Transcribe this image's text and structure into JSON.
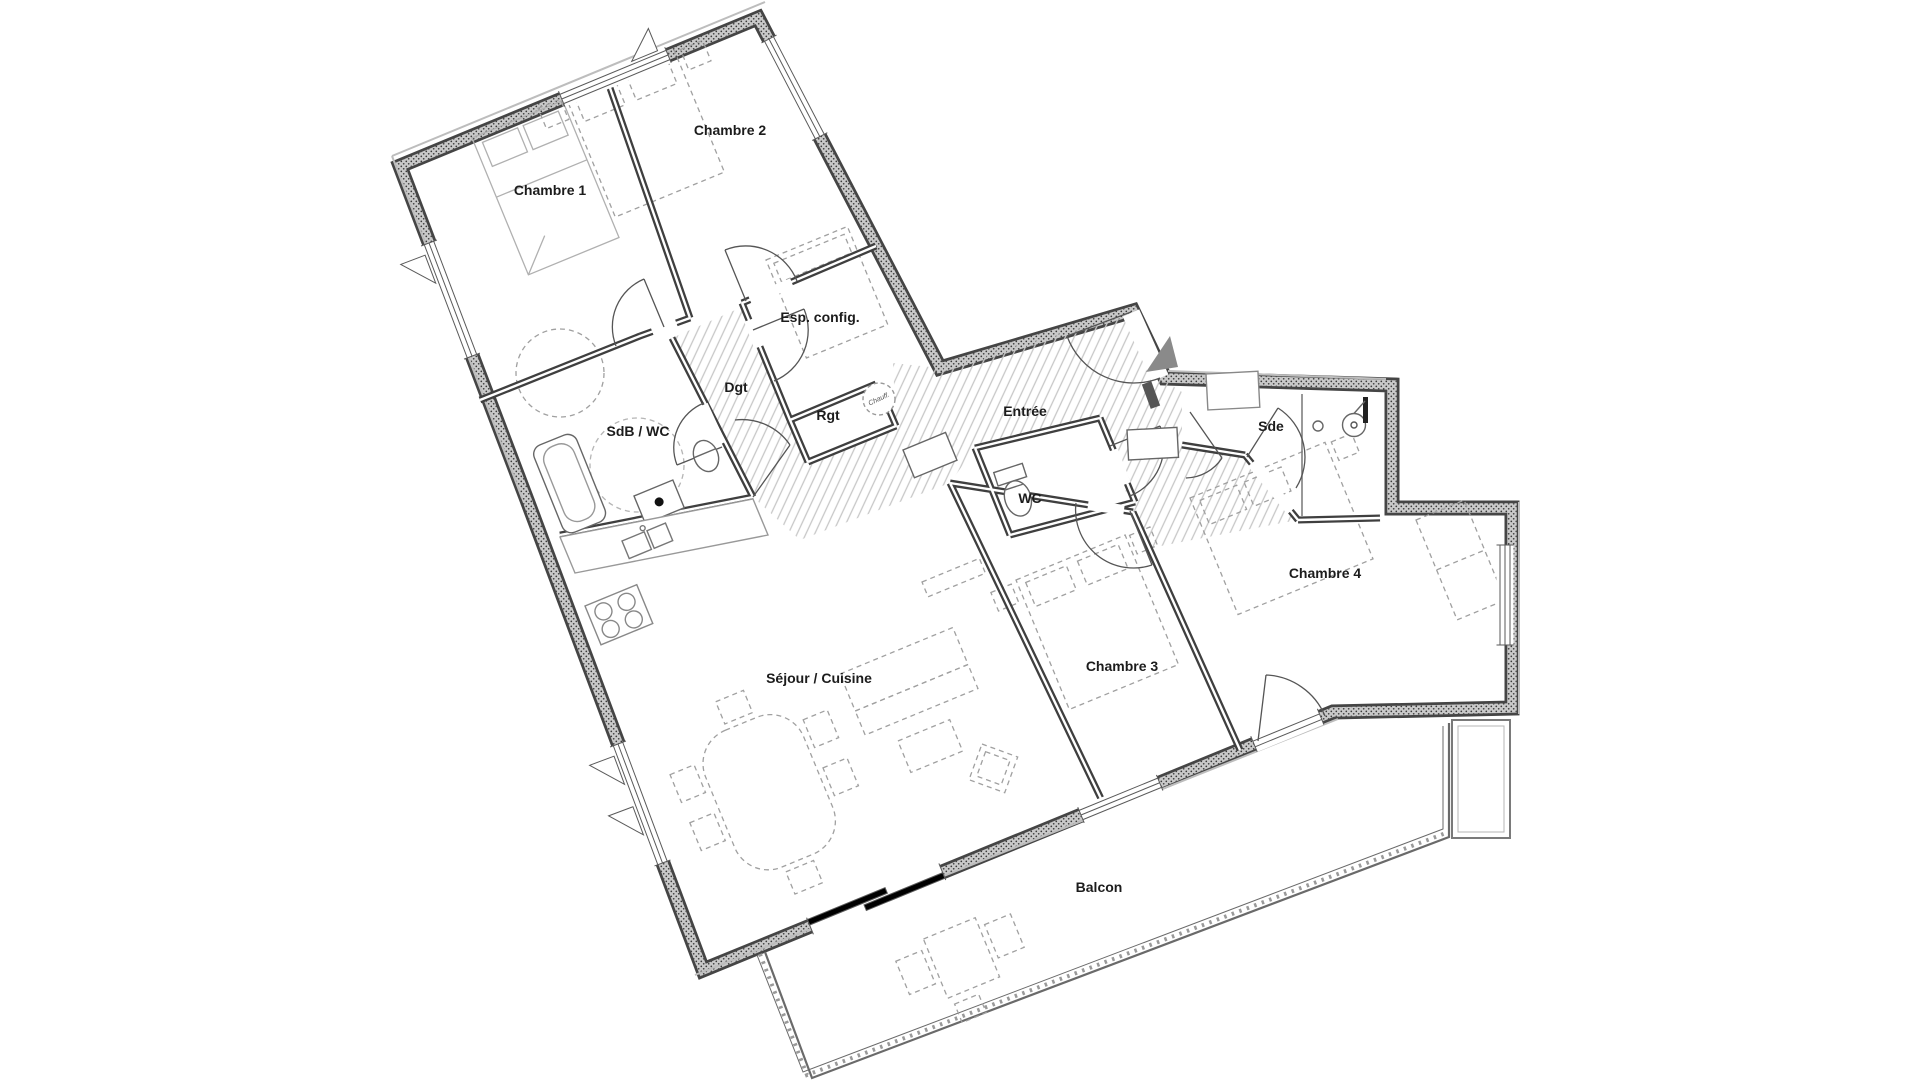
{
  "plan": {
    "type": "apartment-floor-plan",
    "language": "fr",
    "rooms": [
      {
        "id": "chambre-1",
        "label": "Chambre 1",
        "x": 550,
        "y": 195
      },
      {
        "id": "chambre-2",
        "label": "Chambre 2",
        "x": 730,
        "y": 135
      },
      {
        "id": "esp-config",
        "label": "Esp. config.",
        "x": 820,
        "y": 322
      },
      {
        "id": "dgt",
        "label": "Dgt",
        "x": 736,
        "y": 392
      },
      {
        "id": "rgt",
        "label": "Rgt",
        "x": 828,
        "y": 420
      },
      {
        "id": "chauff",
        "label": "Chauff.",
        "x": 879,
        "y": 401
      },
      {
        "id": "sdb-wc",
        "label": "SdB / WC",
        "x": 638,
        "y": 436
      },
      {
        "id": "entree",
        "label": "Entrée",
        "x": 1025,
        "y": 416
      },
      {
        "id": "wc",
        "label": "WC",
        "x": 1030,
        "y": 503
      },
      {
        "id": "sde",
        "label": "Sde",
        "x": 1271,
        "y": 431
      },
      {
        "id": "chambre-4",
        "label": "Chambre 4",
        "x": 1325,
        "y": 578
      },
      {
        "id": "chambre-3",
        "label": "Chambre 3",
        "x": 1122,
        "y": 671
      },
      {
        "id": "sejour-cuisine",
        "label": "Séjour / Cuisine",
        "x": 819,
        "y": 683
      },
      {
        "id": "balcon",
        "label": "Balcon",
        "x": 1099,
        "y": 892
      }
    ],
    "fixtures": [
      "bathtub",
      "washbasin",
      "toilet",
      "shower",
      "kitchen-sink",
      "stove",
      "washing-machine",
      "water-heater",
      "dining-table",
      "sofa",
      "coffee-table",
      "armchair",
      "double-bed",
      "wardrobe",
      "balcony-table",
      "entrance-arrow"
    ],
    "colors": {
      "background": "#ffffff",
      "wall_dark": "#454545",
      "wall_fill": "#c9c9c9",
      "interior_wall": "#3f3f3f",
      "hatch": "#c7c7c7",
      "furniture_dash": "#a0a0a0",
      "fixture_line": "#666666",
      "label_text": "#1c1c1c",
      "entrance_arrow": "#8a8a8a"
    }
  }
}
